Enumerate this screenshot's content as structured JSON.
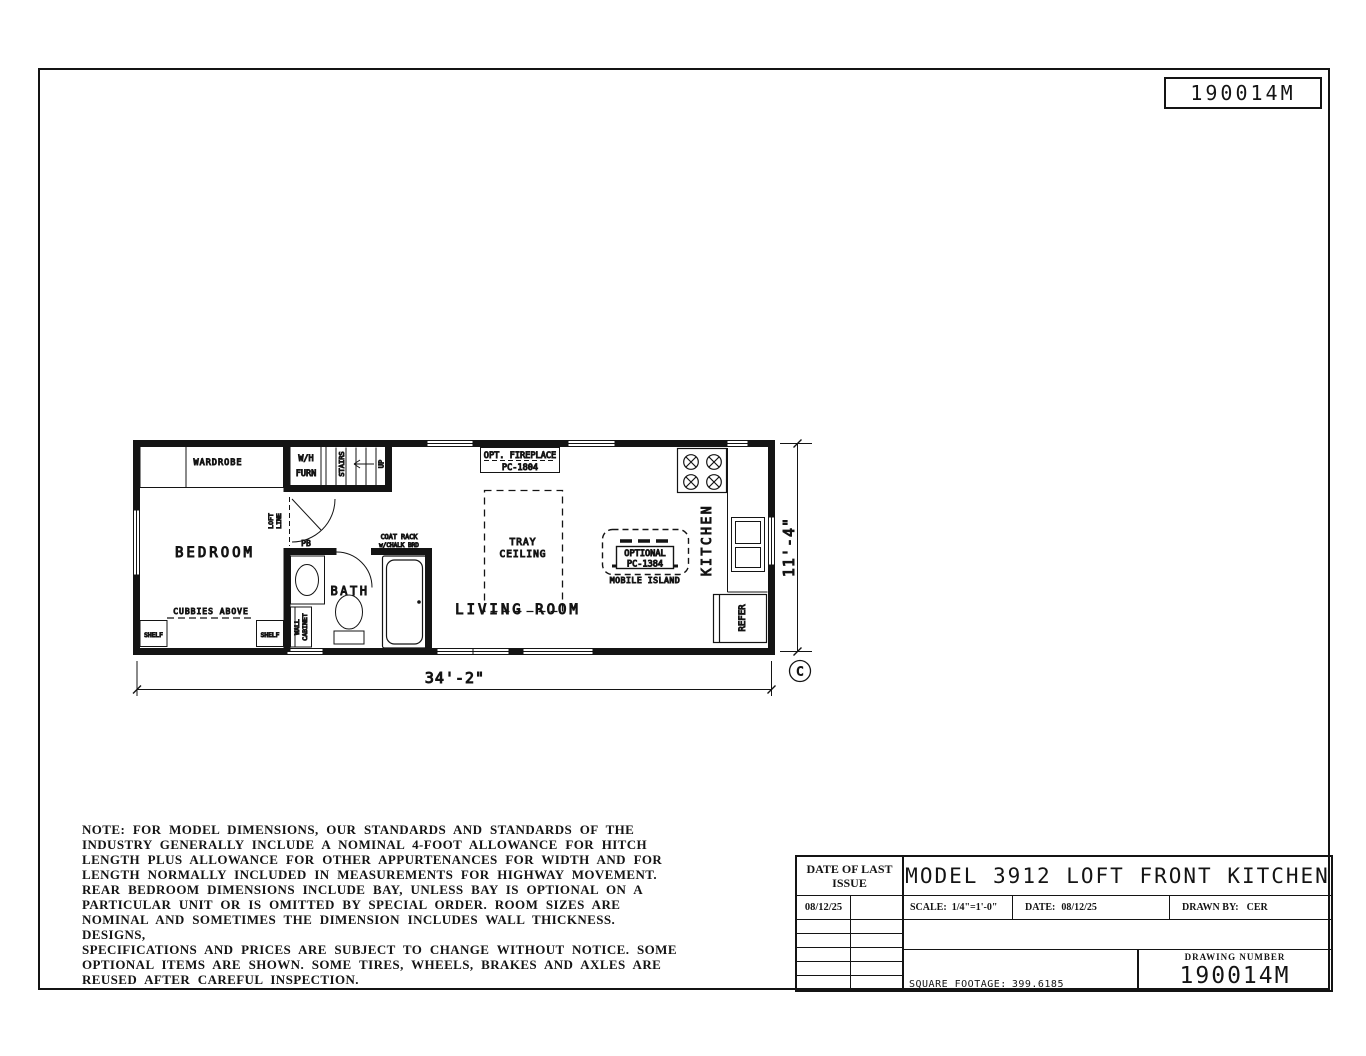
{
  "ink": "#141414",
  "corner_box": {
    "number": "190014M"
  },
  "plan": {
    "rooms": {
      "bedroom": "BEDROOM",
      "bath": "BATH",
      "living_room": "LIVING ROOM",
      "kitchen": "KITCHEN"
    },
    "labels": {
      "wardrobe": "WARDROBE",
      "wh_line1": "W/H",
      "wh_line2": "FURN",
      "stairs": "STAIRS",
      "up": "UP",
      "loft_line1": "LOFT",
      "loft_line2": "LINE",
      "pb": "PB",
      "coat_rack_line1": "COAT RACK",
      "coat_rack_line2": "w/CHALK BRD",
      "wall_cabinet_line1": "WALL",
      "wall_cabinet_line2": "CABINET",
      "cubbies": "CUBBIES ABOVE",
      "shelf_left": "SHELF",
      "shelf_right": "SHELF",
      "fireplace_line1": "OPT. FIREPLACE",
      "fireplace_line2": "PC-1804",
      "tray_line1": "TRAY",
      "tray_line2": "CEILING",
      "island_line1": "OPTIONAL",
      "island_line2": "PC-1384",
      "island_caption": "MOBILE ISLAND",
      "refer": "REFER"
    },
    "dimensions": {
      "width": "34'-2\"",
      "height": "11'-4\"",
      "revision": "C"
    }
  },
  "title_block": {
    "date_of_last_issue_line1": "DATE OF LAST",
    "date_of_last_issue_line2": "ISSUE",
    "issue_date": "08/12/25",
    "model_title": "MODEL 3912 LOFT FRONT KITCHEN",
    "scale_label": "SCALE:",
    "scale_value": "1/4\"=1'-0\"",
    "date_label": "DATE:",
    "date_value": "08/12/25",
    "drawn_by_label": "DRAWN BY:",
    "drawn_by_value": "CER",
    "square_footage_label": "SQUARE FOOTAGE:",
    "square_footage_value": "399.6185",
    "drawing_number_label": "DRAWING NUMBER",
    "drawing_number": "190014M"
  },
  "note": {
    "text": "NOTE: FOR MODEL DIMENSIONS, OUR STANDARDS AND STANDARDS OF THE\nINDUSTRY GENERALLY INCLUDE A NOMINAL 4-FOOT ALLOWANCE FOR HITCH\nLENGTH PLUS ALLOWANCE FOR OTHER APPURTENANCES FOR WIDTH AND FOR\nLENGTH NORMALLY INCLUDED IN MEASUREMENTS FOR HIGHWAY MOVEMENT.\nREAR BEDROOM DIMENSIONS INCLUDE BAY, UNLESS BAY IS OPTIONAL ON A\nPARTICULAR UNIT OR IS OMITTED BY SPECIAL ORDER. ROOM SIZES ARE\nNOMINAL AND SOMETIMES THE DIMENSION INCLUDES WALL THICKNESS. DESIGNS,\nSPECIFICATIONS AND PRICES ARE SUBJECT TO CHANGE WITHOUT NOTICE. SOME\nOPTIONAL ITEMS ARE SHOWN. SOME TIRES, WHEELS, BRAKES AND AXLES ARE\nREUSED AFTER CAREFUL INSPECTION."
  }
}
